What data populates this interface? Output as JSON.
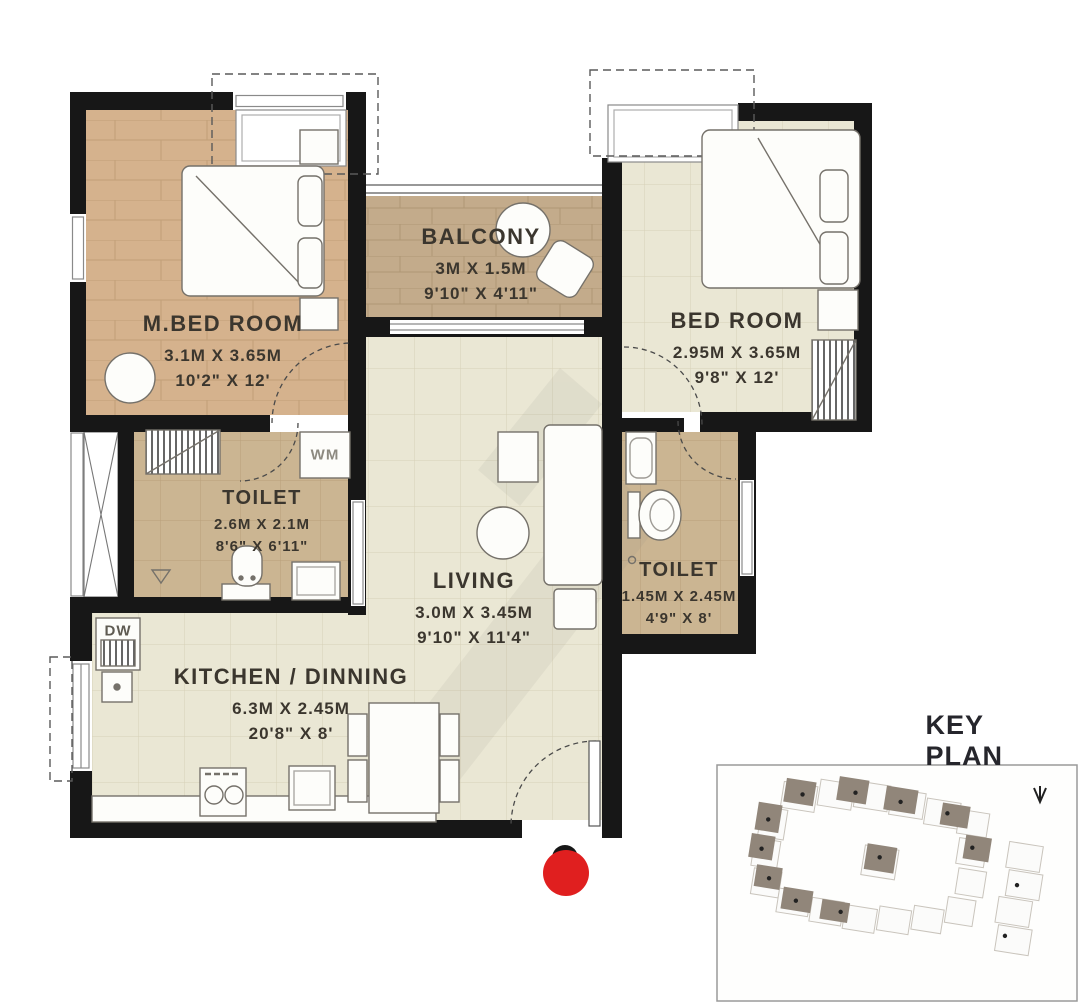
{
  "plan": {
    "rooms": [
      {
        "name": "M.BED ROOM",
        "dim_m": "3.1M X 3.65M",
        "dim_ft": "10'2\" X 12'"
      },
      {
        "name": "BALCONY",
        "dim_m": "3M X 1.5M",
        "dim_ft": "9'10\" X 4'11\""
      },
      {
        "name": "BED ROOM",
        "dim_m": "2.95M X 3.65M",
        "dim_ft": "9'8\" X 12'"
      },
      {
        "name": "TOILET",
        "dim_m": "2.6M X 2.1M",
        "dim_ft": "8'6\" X 6'11\""
      },
      {
        "name": "LIVING",
        "dim_m": "3.0M X 3.45M",
        "dim_ft": "9'10\" X 11'4\""
      },
      {
        "name": "TOILET",
        "dim_m": "1.45M X 2.45M",
        "dim_ft": "4'9\" X 8'"
      },
      {
        "name": "KITCHEN / DINNING",
        "dim_m": "6.3M X 2.45M",
        "dim_ft": "20'8\" X 8'"
      }
    ],
    "appliance_labels": {
      "washing_machine": "WM",
      "dishwasher": "DW"
    },
    "key_plan": {
      "title": "KEY PLAN"
    },
    "colors": {
      "wall": "#171717",
      "wood_floor": "#d5b28d",
      "tile_floor": "#eae7d4",
      "balcony_floor": "#c3ab8b",
      "toilet_floor": "#cbb592",
      "entrance_marker_red": "#e01f1f",
      "keyplan_building": "#91867a"
    }
  }
}
